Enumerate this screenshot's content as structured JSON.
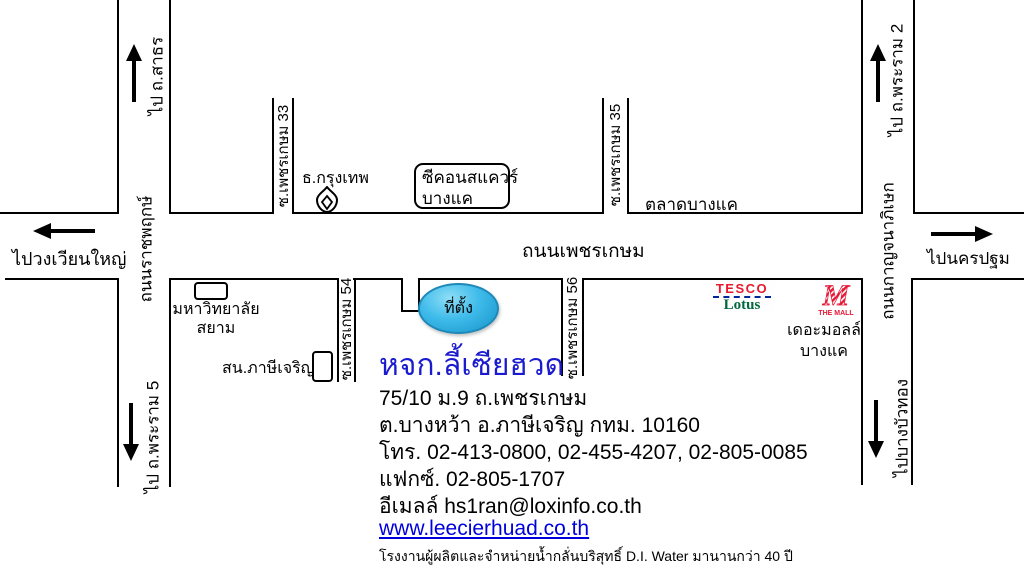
{
  "map": {
    "roads": {
      "phetkasem": "ถนนเพชรเกษม",
      "ratchaphruek": "ถนนราชพฤกษ์",
      "kanchanaphisek": "ถนนกาญจนาภิเษก",
      "soi33": "ซ.เพชรเกษม 33",
      "soi35": "ซ.เพชรเกษม 35",
      "soi54": "ซ.เพชรเกษม 54",
      "soi56": "ซ.เพชรเกษม 56"
    },
    "directions": {
      "sathorn": "ไป ถ.สาธร",
      "wongwianyai": "ไปวงเวียนใหญ่",
      "rama2": "ไป ถ.พระราม 2",
      "nakhonpathom": "ไปนครปฐม",
      "rama5": "ไป ถ.พระราม 5",
      "bangbuathong": "ไปบางบัวทอง"
    },
    "places": {
      "bangkok_bank": "ธ.กรุงเทพ",
      "seacon_line1": "ซีคอนสแควร์",
      "seacon_line2": "บางแค",
      "talad_bangkae": "ตลาดบางแค",
      "siam_university_line1": "มหาวิทยาลัย",
      "siam_university_line2": "สยาม",
      "police_station": "สน.ภาษีเจริญ",
      "the_mall_line1": "เดอะมอลล์",
      "the_mall_line2": "บางแค",
      "location_marker": "ที่ตั้ง"
    },
    "logos": {
      "tesco_line1": "TESCO",
      "tesco_line2": "Lotus",
      "mall_m": "M",
      "the_mall": "THE MALL"
    }
  },
  "company": {
    "name": "หจก.ลี้เซียฮวด",
    "address_line1": "75/10 ม.9 ถ.เพชรเกษม",
    "address_line2": "ต.บางหว้า อ.ภาษีเจริญ กทม. 10160",
    "phone": "โทร. 02-413-0800, 02-455-4207, 02-805-0085",
    "fax": "แฟกซ์. 02-805-1707",
    "email": "อีเมลล์ hs1ran@loxinfo.co.th",
    "website": "www.leecierhuad.co.th",
    "tagline": "โรงงานผู้ผลิตและจำหน่ายน้ำกลั่นบริสุทธิ์ D.I. Water มานานกว่า 40 ปี"
  },
  "colors": {
    "company_name": "#1a1ace",
    "link": "#0000dd",
    "marker_fill": "#3ebbea",
    "marker_border": "#1e88b8",
    "tesco_red": "#e8192c",
    "tesco_blue": "#00269a",
    "lotus_green": "#00693e",
    "mall_red": "#e51937"
  }
}
